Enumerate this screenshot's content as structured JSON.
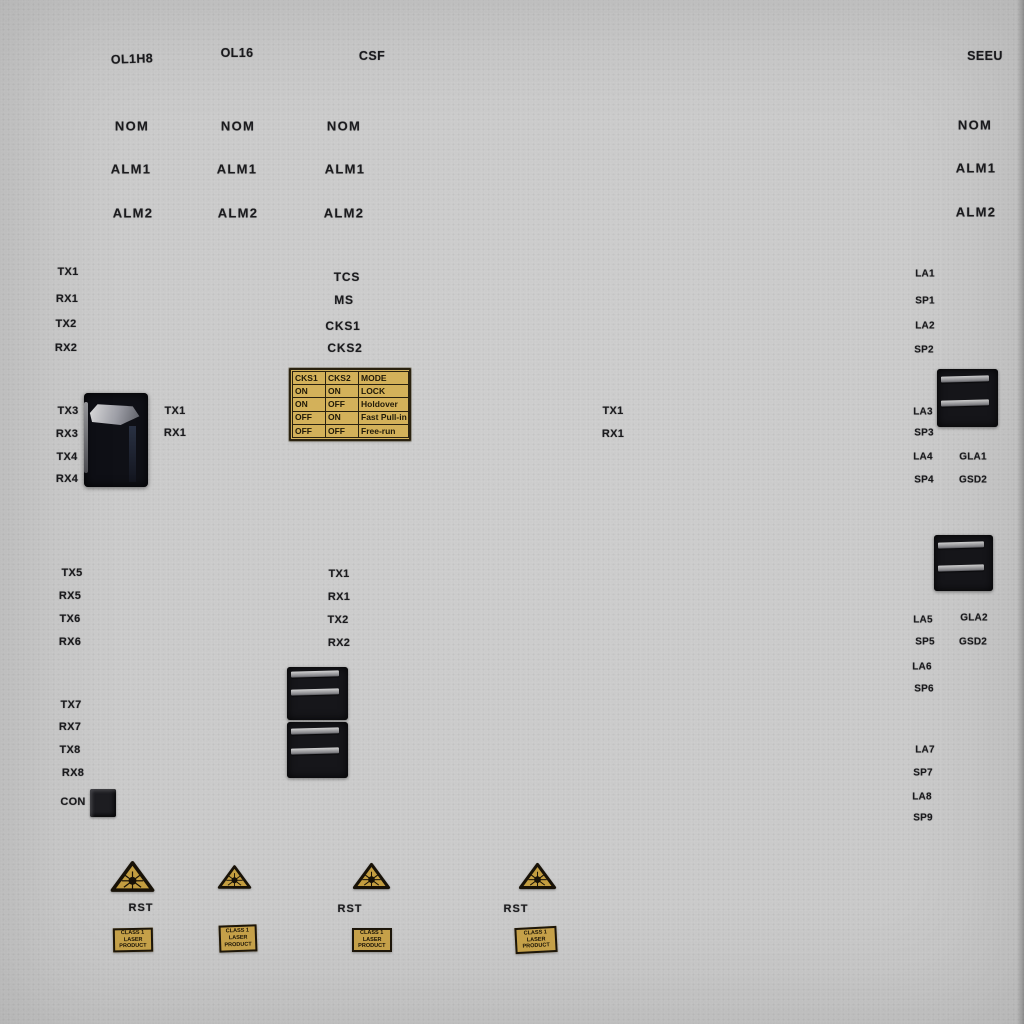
{
  "panel_colors": {
    "background": "#c8c8c8",
    "label": "#1b1b1e",
    "sticker_gold": "#c7a24a",
    "table_gold": "#d3b15a",
    "connector_dark": "#16161a",
    "slot_metal": "#d2d2d2"
  },
  "boards": {
    "titles": [
      "OL1H8",
      "OL16",
      "CSF",
      "SEEU"
    ],
    "led_labels": [
      "NOM",
      "ALM1",
      "ALM2"
    ]
  },
  "ports": {
    "left_group1": [
      "TX1",
      "RX1",
      "TX2",
      "RX2"
    ],
    "left_connector_labels": [
      "TX3",
      "RX3",
      "TX4",
      "RX4"
    ],
    "left_connector_right_labels": [
      "TX1",
      "RX1"
    ],
    "left_group2": [
      "TX5",
      "RX5",
      "TX6",
      "RX6"
    ],
    "left_group3": [
      "TX7",
      "RX7",
      "TX8",
      "RX8"
    ],
    "console_label": "CON",
    "center_clock_labels": [
      "TCS",
      "MS",
      "CKS1",
      "CKS2"
    ],
    "center_mid_labels": [
      "TX1",
      "RX1"
    ],
    "center_group2": [
      "TX1",
      "RX1",
      "TX2",
      "RX2"
    ],
    "right_group1": [
      "LA1",
      "SP1",
      "LA2",
      "SP2"
    ],
    "right_group2": [
      "LA3",
      "SP3",
      "LA4",
      "SP4"
    ],
    "right_group2_extra": [
      "GLA1",
      "GSD2"
    ],
    "right_group3": [
      "LA5",
      "SP5",
      "LA6",
      "SP6"
    ],
    "right_group3_extra": [
      "GLA2",
      "GSD2"
    ],
    "right_group4": [
      "LA7",
      "SP7",
      "LA8",
      "SP9"
    ]
  },
  "mode_table": {
    "headers": [
      "CKS1",
      "CKS2",
      "MODE"
    ],
    "rows": [
      [
        "ON",
        "ON",
        "LOCK"
      ],
      [
        "ON",
        "OFF",
        "Holdover"
      ],
      [
        "OFF",
        "ON",
        "Fast Pull-in"
      ],
      [
        "OFF",
        "OFF",
        "Free-run"
      ]
    ]
  },
  "reset_label": "RST",
  "laser_sticker_lines": [
    "CLASS 1",
    "LASER",
    "PRODUCT"
  ]
}
